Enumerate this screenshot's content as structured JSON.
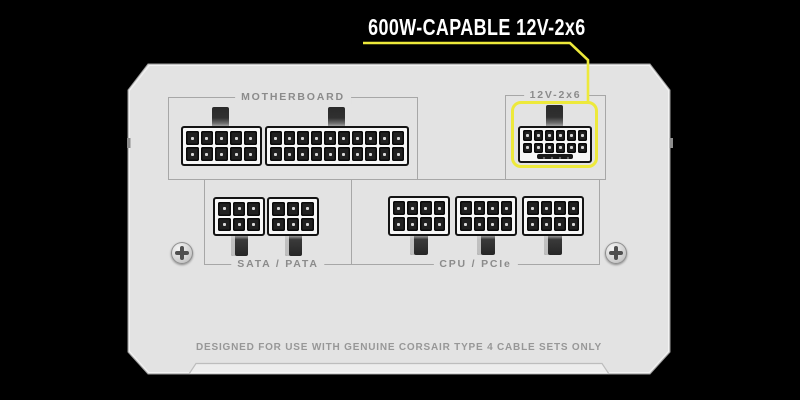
{
  "callout": {
    "label": "600W-CAPABLE 12V-2x6",
    "accent_color": "#EDE93B"
  },
  "panel": {
    "background_color": "#E3E3E3",
    "sections": [
      {
        "label": "MOTHERBOARD",
        "legend_position": "top"
      },
      {
        "label": "12V-2x6",
        "legend_position": "top",
        "highlighted": true,
        "highlight_color": "#EDE93B"
      },
      {
        "label": "SATA / PATA",
        "legend_position": "bottom"
      },
      {
        "label": "CPU / PCIe",
        "legend_position": "bottom"
      }
    ],
    "connectors": {
      "motherboard_10pin": {
        "cols": 5,
        "rows": 2,
        "pins": 10
      },
      "motherboard_20pin": {
        "cols": 10,
        "rows": 2,
        "pins": 20
      },
      "pcie5_12v2x6": {
        "cols": 6,
        "rows": 2,
        "pins": 12,
        "sense_bar": true
      },
      "sata_pata_6pin_a": {
        "cols": 3,
        "rows": 2,
        "pins": 6
      },
      "sata_pata_6pin_b": {
        "cols": 3,
        "rows": 2,
        "pins": 6
      },
      "cpu_pcie_8pin_a": {
        "cols": 4,
        "rows": 2,
        "pins": 8
      },
      "cpu_pcie_8pin_b": {
        "cols": 4,
        "rows": 2,
        "pins": 8
      },
      "cpu_pcie_8pin_c": {
        "cols": 4,
        "rows": 2,
        "pins": 8
      }
    },
    "footer": "DESIGNED FOR USE WITH GENUINE CORSAIR TYPE 4 CABLE SETS ONLY"
  }
}
